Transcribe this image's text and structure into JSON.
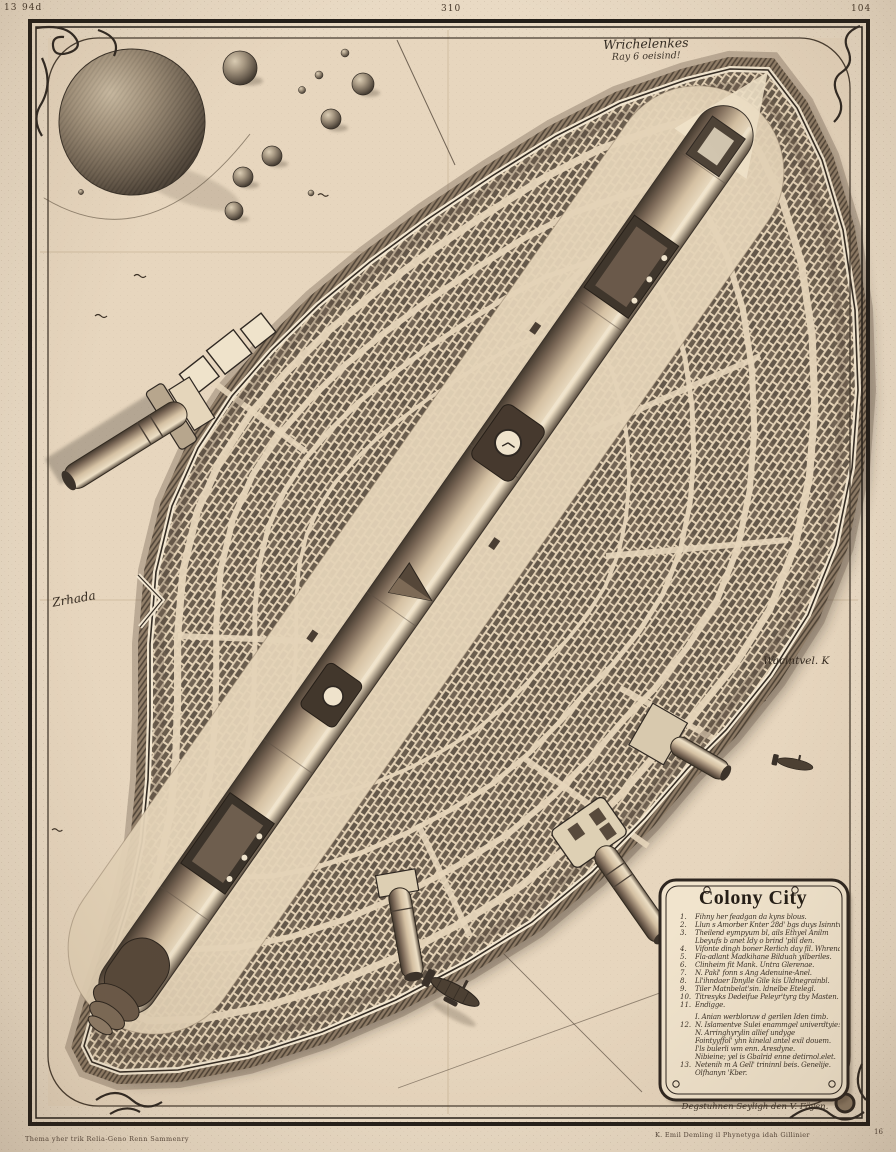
{
  "page": {
    "plate_marks": {
      "far_left": "13",
      "left": "94d",
      "center": "310",
      "right": "104"
    },
    "margin_notes": {
      "bottom_left": "Thema yher trik Relia-Geno Renn Sammenry",
      "bottom_right": "K. Emil Demling il Phynetyga idah Gillinier",
      "bottom_right_mark": "16"
    },
    "colors": {
      "paper": "#e9dac4",
      "ink": "#2f2822",
      "wall_light": "#f2e6d0",
      "shadow": "#241c13"
    }
  },
  "map": {
    "note_top_line1": "Wrichelenkes",
    "note_top_line2": "Ray 6 oeisind!",
    "label_west": "Zrhada",
    "label_east": "Wacintvel. K",
    "signature": "Degstuhnen Seyligh den V. Föyen."
  },
  "cartouche": {
    "title": "Colony City",
    "rows": [
      {
        "num": "1.",
        "text": "Fihny her feadgan da kyns blous."
      },
      {
        "num": "2.",
        "text": "Llun s Amorber Knter 28d' bgs duys Isinntve."
      },
      {
        "num": "3.",
        "text": "Theilend eympyum bl, ails Ethyel Anilm"
      },
      {
        "num": "",
        "text": "Lbeyufs b anet Idy o brind 'plil den."
      },
      {
        "num": "4.",
        "text": "Vifonte dingh boner Rerlich day fil. Whrenadin"
      },
      {
        "num": "5.",
        "text": "Fla-adlant Madkihane Bilduah yilberiles."
      },
      {
        "num": "6.",
        "text": "Clinheim fit Mank. Untra Glerenae."
      },
      {
        "num": "7.",
        "text": "N. Pakl' fonn s Ang Adenuine-Anel."
      },
      {
        "num": "8.",
        "text": "Ll'ihndaer Ibnylle Gile kis Uldnegrainbl."
      },
      {
        "num": "9.",
        "text": "Tiler Matnbelat'sin. ldnelbe Etelegl."
      },
      {
        "num": "10.",
        "text": "Titresyks Dedeifue Peleyr'tyrg tby Masten."
      },
      {
        "num": "11.",
        "text": "Endigge."
      },
      {
        "num": "",
        "text": "I. Anian werbloruw d gerilen Iden timb."
      },
      {
        "num": "12.",
        "text": "N. Islamentve Sulei enammgel univerdtyie:"
      },
      {
        "num": "",
        "text": "N. Arringhyrylin allief undyge"
      },
      {
        "num": "",
        "text": "Fointyyffol' yhn kinelal antel exil douem."
      },
      {
        "num": "",
        "text": "I'ls bulerli wm enn. Aresdyne."
      },
      {
        "num": "",
        "text": "Nibieine; yel is Gbalrid enne detirnol.elet."
      },
      {
        "num": "13.",
        "text": "Netenih m A Gell' trininnl beis. Genelije."
      },
      {
        "num": "",
        "text": "Olfhanyn 'Kber."
      }
    ]
  }
}
